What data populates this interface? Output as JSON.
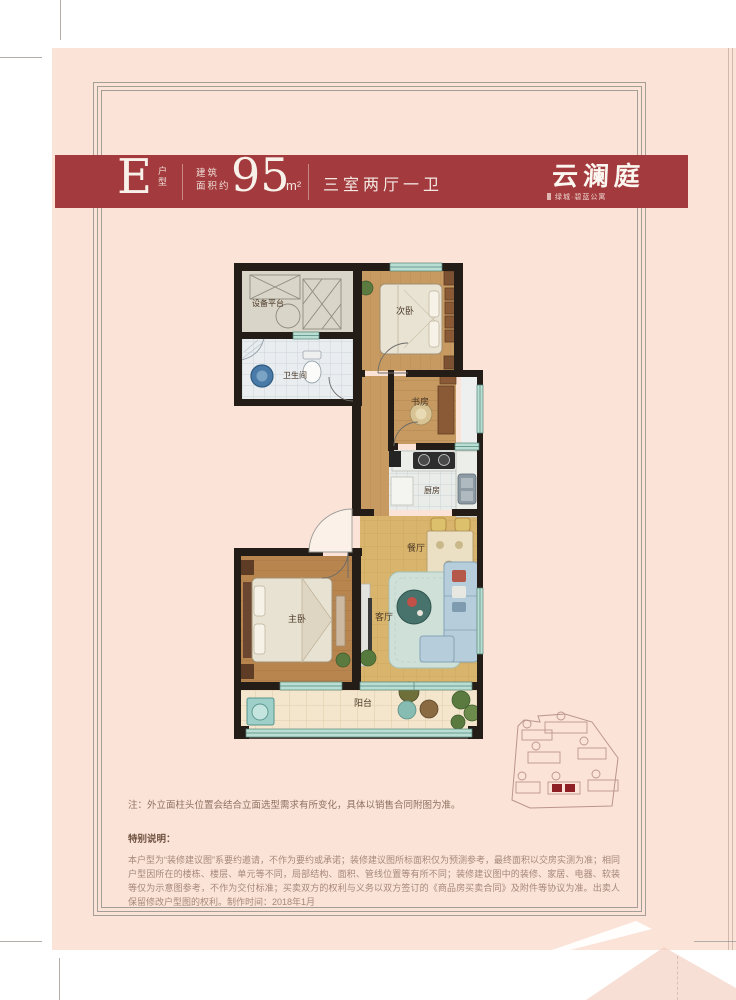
{
  "header": {
    "unit_letter": "E",
    "unit_type_label": "户型",
    "area_label_line1": "建筑",
    "area_label_line2": "面积约",
    "area_value": "95",
    "area_unit": "m²",
    "layout": "三室两厅一卫"
  },
  "brand": {
    "name": "云澜庭",
    "subtitle": "绿城·碧蓝公寓"
  },
  "floorplan": {
    "rooms": [
      {
        "label": "设备平台"
      },
      {
        "label": "次卧"
      },
      {
        "label": "卫生间"
      },
      {
        "label": "书房"
      },
      {
        "label": "厨房"
      },
      {
        "label": "餐厅"
      },
      {
        "label": "主卧"
      },
      {
        "label": "客厅"
      },
      {
        "label": "阳台"
      }
    ]
  },
  "notes": {
    "facade_note": "注：外立面柱头位置会结合立面选型需求有所变化，具体以销售合同附图为准。",
    "special_title": "特别说明：",
    "special_body": "本户型为“装修建议图”系要约邀请，不作为要约或承诺；装修建议图所标面积仅为预测参考，最终面积以交房实测为准；相同户型因所在的楼栋、楼层、单元等不同，局部结构、面积、管线位置等有所不同；装修建议图中的装修、家居、电器、软装等仅为示意图参考，不作为交付标准；买卖双方的权利与义务以双方签订的《商品房买卖合同》及附件等协议为准。出卖人保留修改户型图的权利。制作时间：2018年1月"
  },
  "colors": {
    "page_bg": "#fbe3d8",
    "band_red": "#a33a3d",
    "wall_black": "#241d17",
    "window_teal": "#b9dfd4",
    "wood_floor": "#c79a61",
    "wood_floor_dark": "#b8854e",
    "tile_floor": "#e9edf0",
    "tan_floor": "#d8b46c",
    "balcony_floor": "#f3e6cd",
    "keyplan_highlight": "#8e2025"
  }
}
